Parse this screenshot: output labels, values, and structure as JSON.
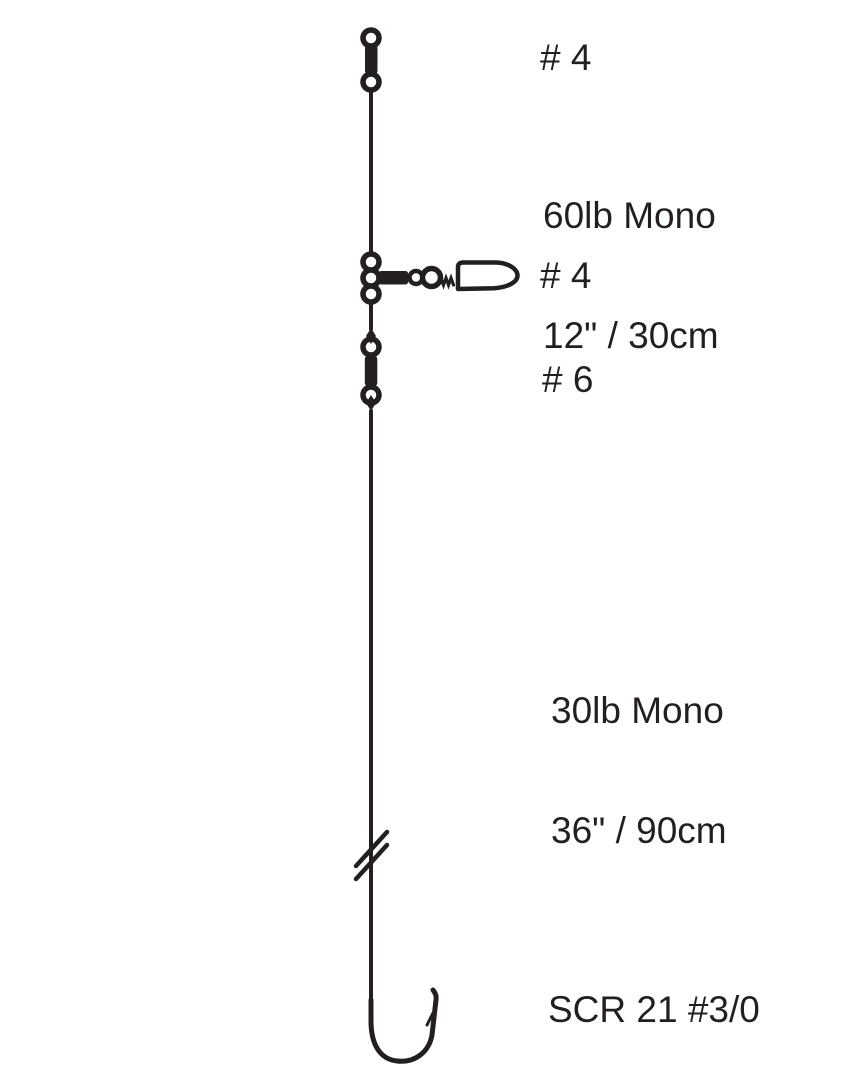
{
  "page": {
    "background": "#ffffff",
    "ink": "#231f20"
  },
  "labels": {
    "top_swivel_size": "# 4",
    "upper_section_line1": "60lb Mono",
    "upper_section_line2": "12\" / 30cm",
    "snap_swivel_size": "# 4",
    "lower_swivel_size": "# 6",
    "lower_section_line1": "30lb Mono",
    "lower_section_line2": "36\" / 90cm",
    "hook_model": "SCR 21 #3/0"
  },
  "icons": {
    "top_swivel": "barrel-swivel",
    "beads": "rig-beads",
    "snap_swivel": "barrel-snap-swivel",
    "lower_swivel": "barrel-swivel",
    "line_break": "line-break-mark",
    "hook": "fishing-hook"
  }
}
